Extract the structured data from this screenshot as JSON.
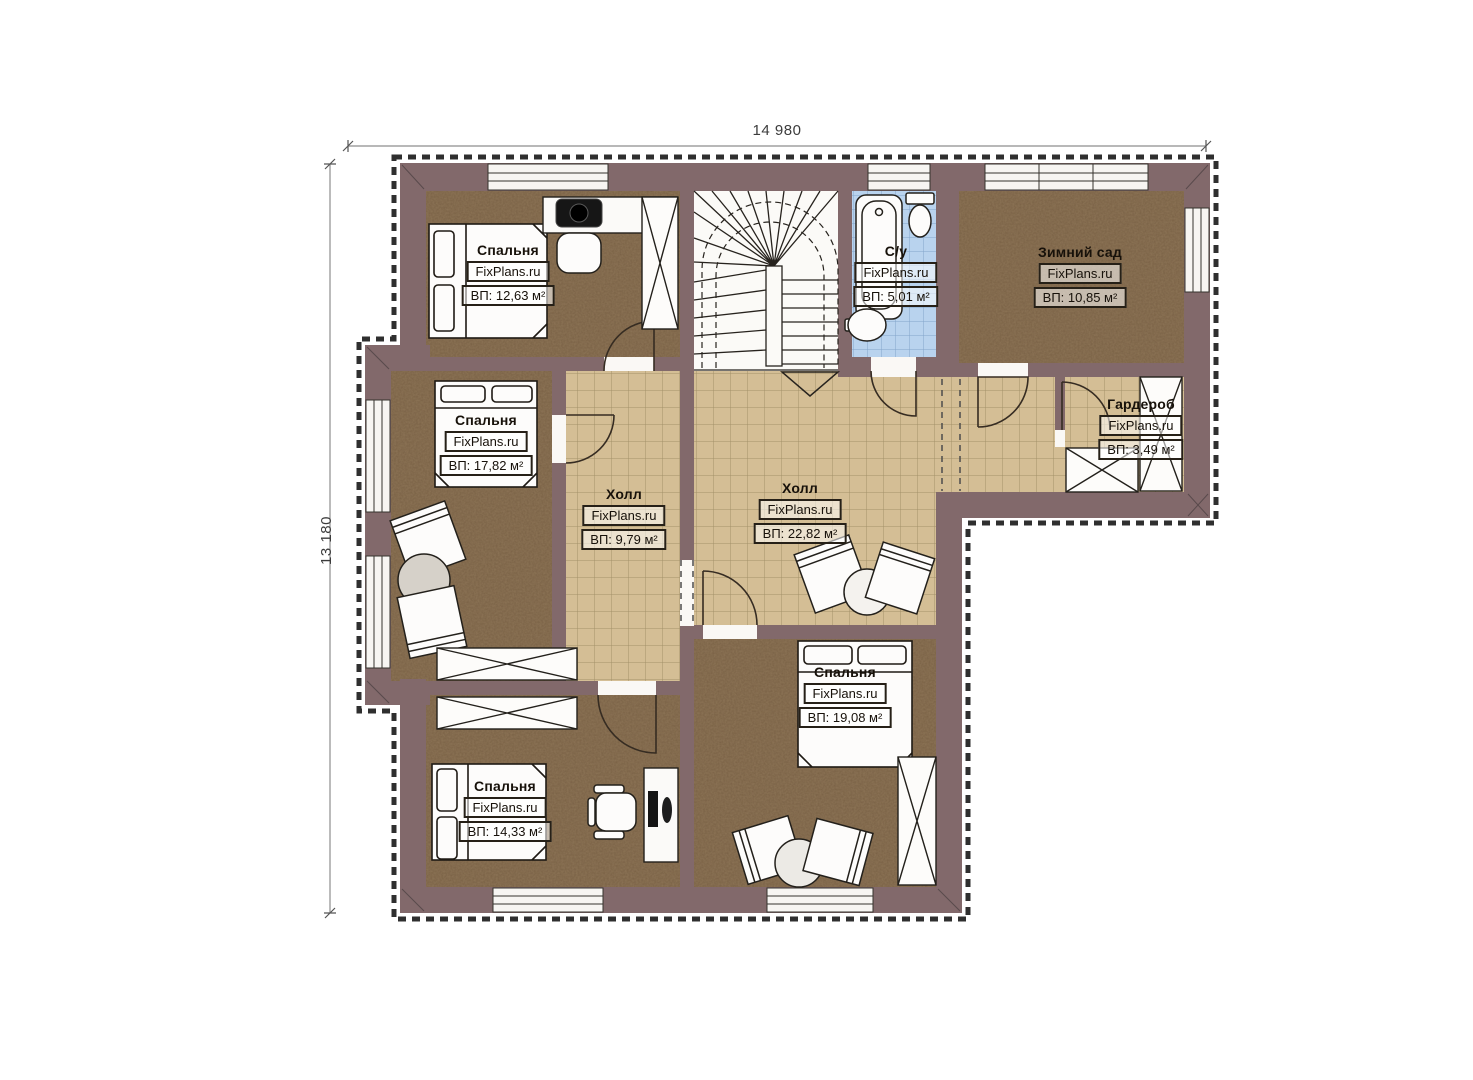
{
  "plan": {
    "watermark": "FixPlans.ru",
    "dimensions": {
      "width": "14 980",
      "height": "13 180"
    },
    "rooms": [
      {
        "id": "bedroom-top-left",
        "name": "Спальня",
        "area": "ВП: 12,63 м²"
      },
      {
        "id": "bedroom-mid-left",
        "name": "Спальня",
        "area": "ВП: 17,82 м²"
      },
      {
        "id": "hall-small",
        "name": "Холл",
        "area": "ВП: 9,79 м²"
      },
      {
        "id": "hall-main",
        "name": "Холл",
        "area": "ВП: 22,82 м²"
      },
      {
        "id": "bathroom",
        "name": "С/у",
        "area": "ВП: 5,01 м²"
      },
      {
        "id": "winter-garden",
        "name": "Зимний сад",
        "area": "ВП: 10,85 м²"
      },
      {
        "id": "wardrobe",
        "name": "Гардероб",
        "area": "ВП: 3,49 м²"
      },
      {
        "id": "bedroom-bottom-middle",
        "name": "Спальня",
        "area": "ВП: 19,08 м²"
      },
      {
        "id": "bedroom-bottom-left",
        "name": "Спальня",
        "area": "ВП: 14,33 м²"
      }
    ],
    "colors": {
      "wall": "#82696b",
      "bedroom_floor": "#8d7456",
      "hall_tile": "#d4be95",
      "bathroom_tile": "#b9d3ee",
      "background": "#ffffff"
    }
  }
}
